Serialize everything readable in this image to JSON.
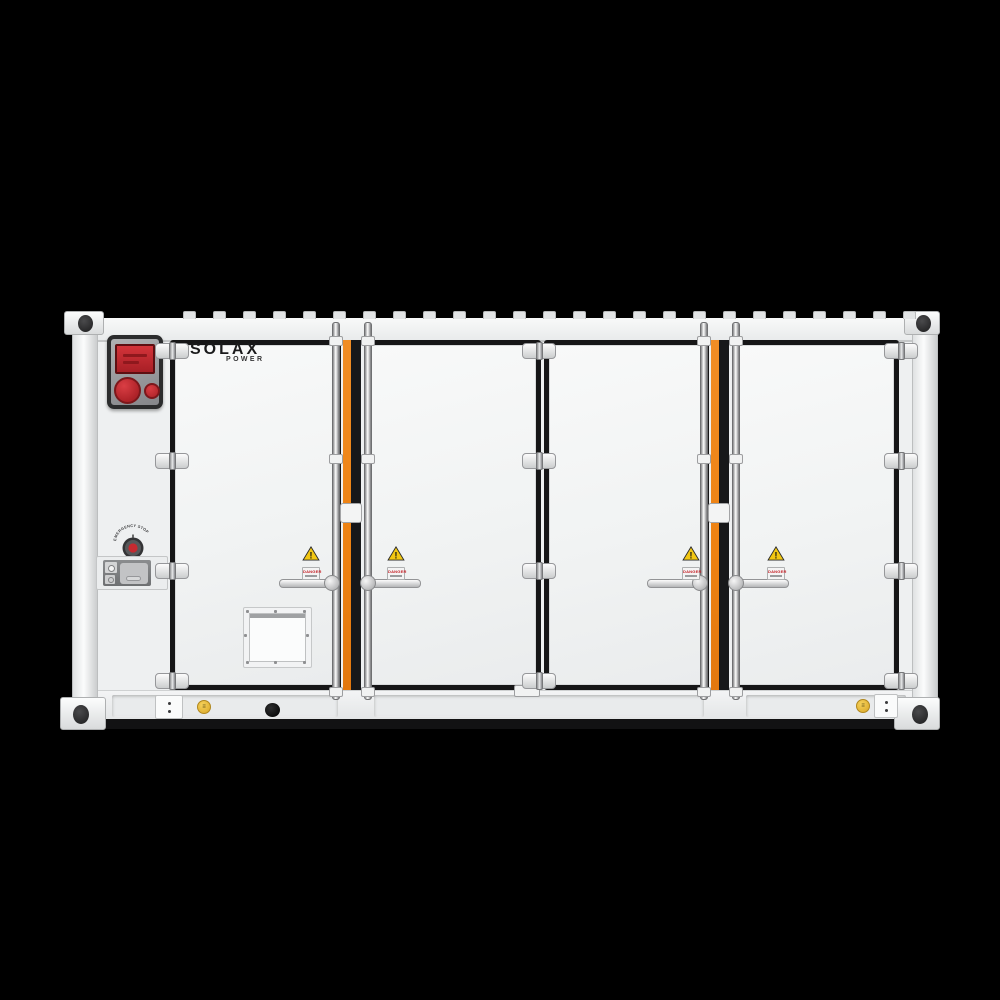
{
  "background_color": "#000000",
  "branding": {
    "primary": "SOLAX",
    "secondary": "POWER"
  },
  "controls": {
    "emergency_stop_label": "EMERGENCY STOP"
  },
  "warning": {
    "text": "DANGER",
    "triangle_glyph": "!"
  },
  "icons": {
    "grounding_glyph": "≡"
  },
  "colors": {
    "background": "#000000",
    "body_white": "#F0F1F2",
    "accent_orange": "#EF8519",
    "gasket_black": "#161617",
    "alarm_red": "#C4272D",
    "warning_yellow": "#F2C713"
  }
}
